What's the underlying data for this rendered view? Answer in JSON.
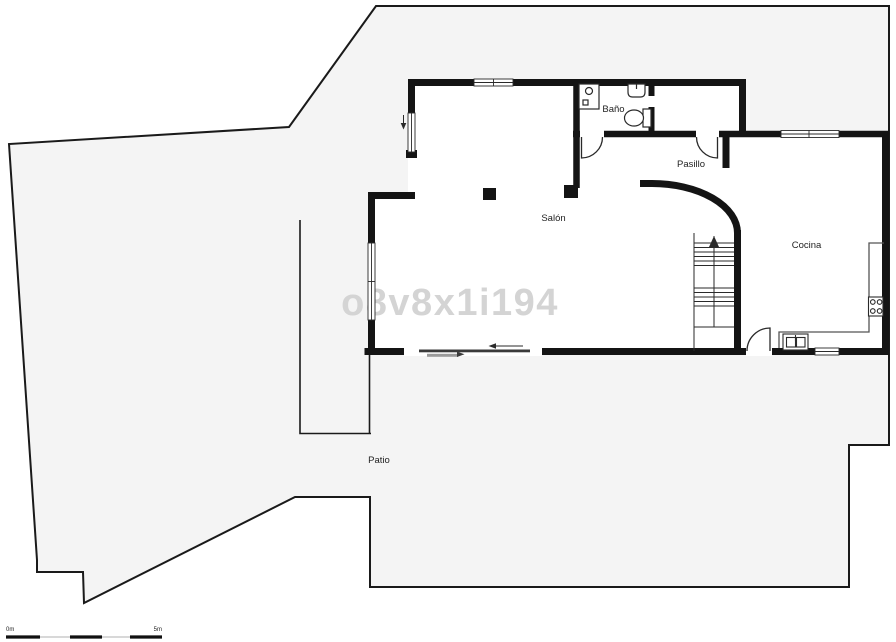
{
  "watermark": "o8v8x1i194",
  "rooms": {
    "bano": "Baño",
    "pasillo": "Pasillo",
    "salon": "Salón",
    "cocina": "Cocina",
    "patio": "Patio"
  },
  "scale_bar": {
    "start_label": "0m",
    "end_label": "5m"
  },
  "colors": {
    "wall": "#141414",
    "outline": "#1a1a1a",
    "parcel_fill": "#f4f4f4",
    "room_fill": "#ffffff",
    "fixture_stroke": "#2a2a2a",
    "counter_stroke": "#555555",
    "watermark": "#d4d4d4",
    "label": "#1f1f1f"
  }
}
